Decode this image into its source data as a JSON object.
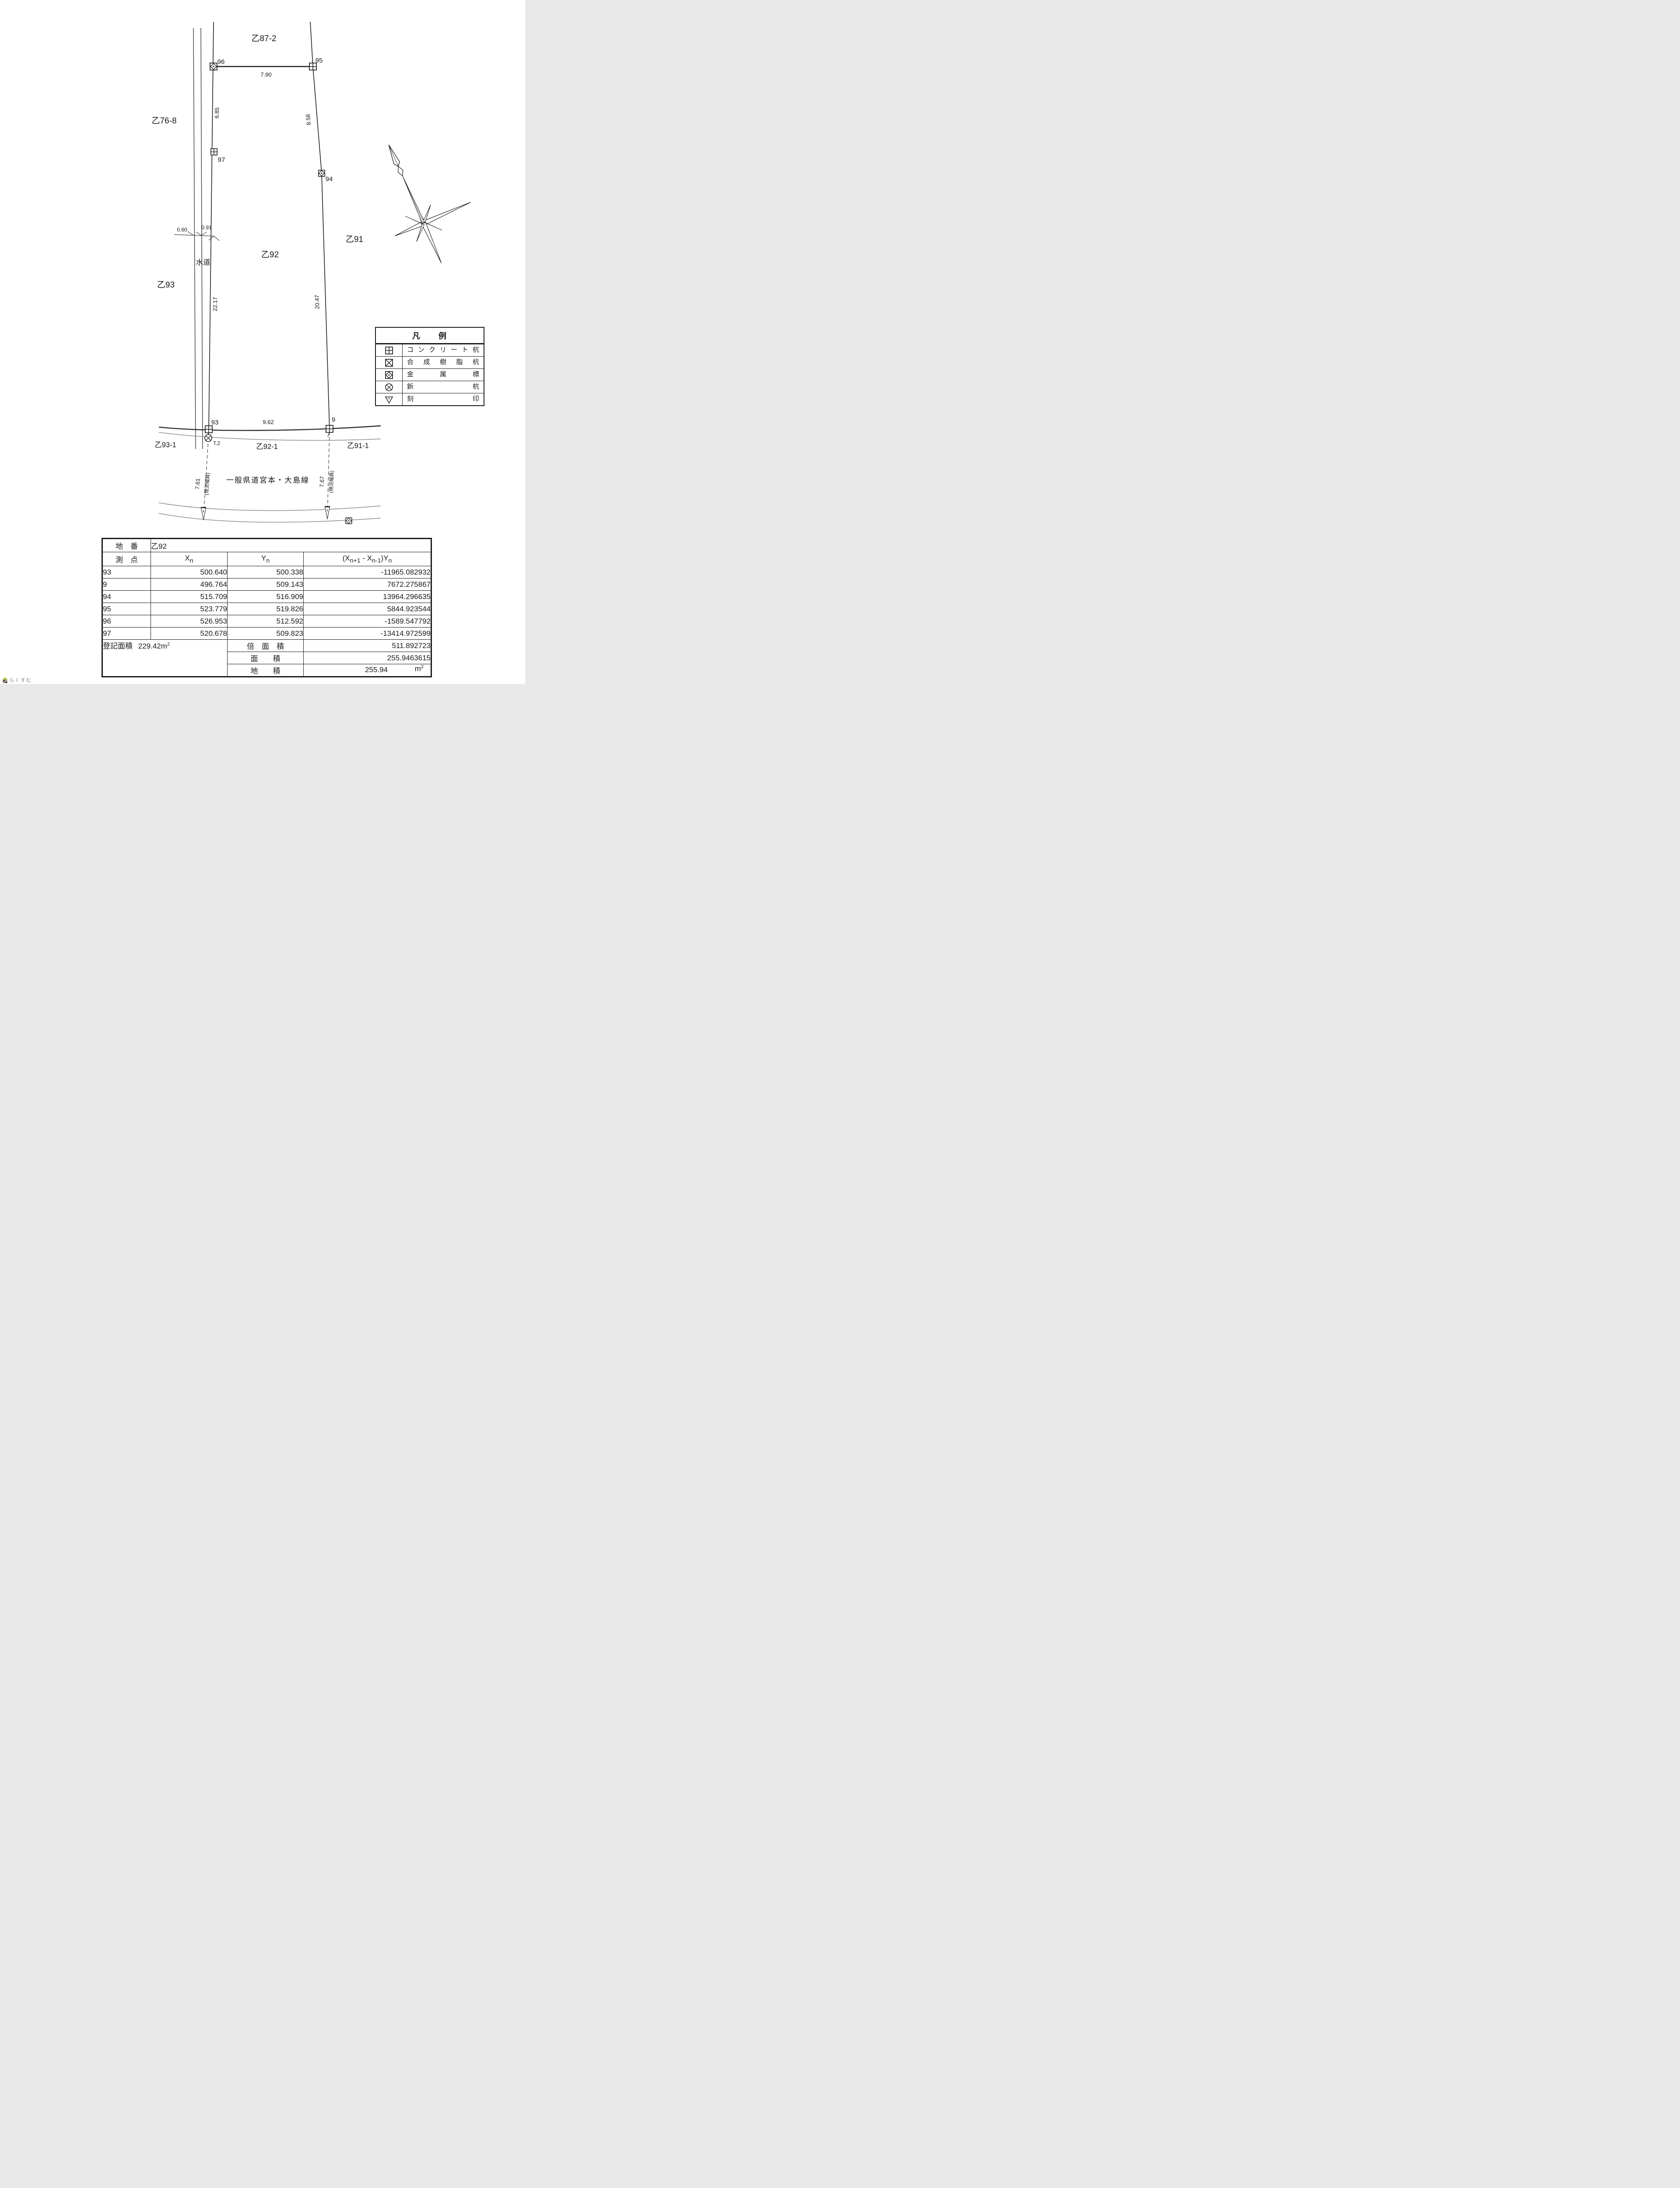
{
  "map": {
    "parcels": {
      "top": "乙87-2",
      "left_upper": "乙76-8",
      "left": "乙93",
      "center": "乙92",
      "right": "乙91",
      "bottom_left": "乙93-1",
      "bottom_center": "乙92-1",
      "bottom_right": "乙91-1"
    },
    "water_label": "水道",
    "road_name": "一般県道宮本・大島線",
    "points": {
      "p96": "96",
      "p95": "95",
      "p97": "97",
      "p94": "94",
      "p93": "93",
      "p9": "9"
    },
    "dims": {
      "d790": "7.90",
      "d685": "6.85",
      "d858": "8.58",
      "d2217": "22.17",
      "d2047": "20.47",
      "d060": "0.60",
      "d091": "0.91",
      "d962": "9.62",
      "d761": "7.61",
      "d767": "7.67",
      "width_note": "(現況幅員)",
      "t2": "T.2"
    }
  },
  "legend": {
    "title": "凡　　例",
    "rows": [
      {
        "symbol": "concrete-pile",
        "label": "コンクリート杭"
      },
      {
        "symbol": "resin-pile",
        "label": "合成樹脂杭"
      },
      {
        "symbol": "metal-marker",
        "label": "金属標"
      },
      {
        "symbol": "nail-pile",
        "label": "鋲杭"
      },
      {
        "symbol": "carved-mark",
        "label": "刻印"
      }
    ]
  },
  "table": {
    "parcel_label": "地　番",
    "parcel_value": "乙92",
    "headers": {
      "point": "測　点",
      "xn_base": "X",
      "xn_sub": "n",
      "yn_base": "Y",
      "yn_sub": "n",
      "cross_p1": "(X",
      "cross_s1": "n+1",
      "cross_p2": " - X",
      "cross_s2": "n-1",
      "cross_p3": ")Y",
      "cross_s3": "n"
    },
    "rows": [
      [
        "93",
        "500.640",
        "500.338",
        "-11965.082932"
      ],
      [
        "9",
        "496.764",
        "509.143",
        "7672.275867"
      ],
      [
        "94",
        "515.709",
        "516.909",
        "13964.296635"
      ],
      [
        "95",
        "523.779",
        "519.826",
        "5844.923544"
      ],
      [
        "96",
        "526.953",
        "512.592",
        "-1589.547792"
      ],
      [
        "97",
        "520.678",
        "509.823",
        "-13414.972599"
      ]
    ],
    "registered_area_label": "登記面積",
    "registered_area_value": "229.42",
    "area_unit": "m",
    "area_sup": "2",
    "footer": [
      {
        "label": "倍　面　積",
        "value": "511.892723"
      },
      {
        "label": "面　　積",
        "value": "255.9463615"
      },
      {
        "label": "地　　積",
        "value": "255.94"
      }
    ]
  },
  "logo": {
    "text": "らくすむ"
  },
  "colors": {
    "ink": "#1b1b1b",
    "road_gray": "#8d8d8d",
    "road_dark": "#2e2e2e",
    "logo_roof": "#aebf3a",
    "logo_body": "#54433a",
    "logo_text": "#8b7e70"
  }
}
